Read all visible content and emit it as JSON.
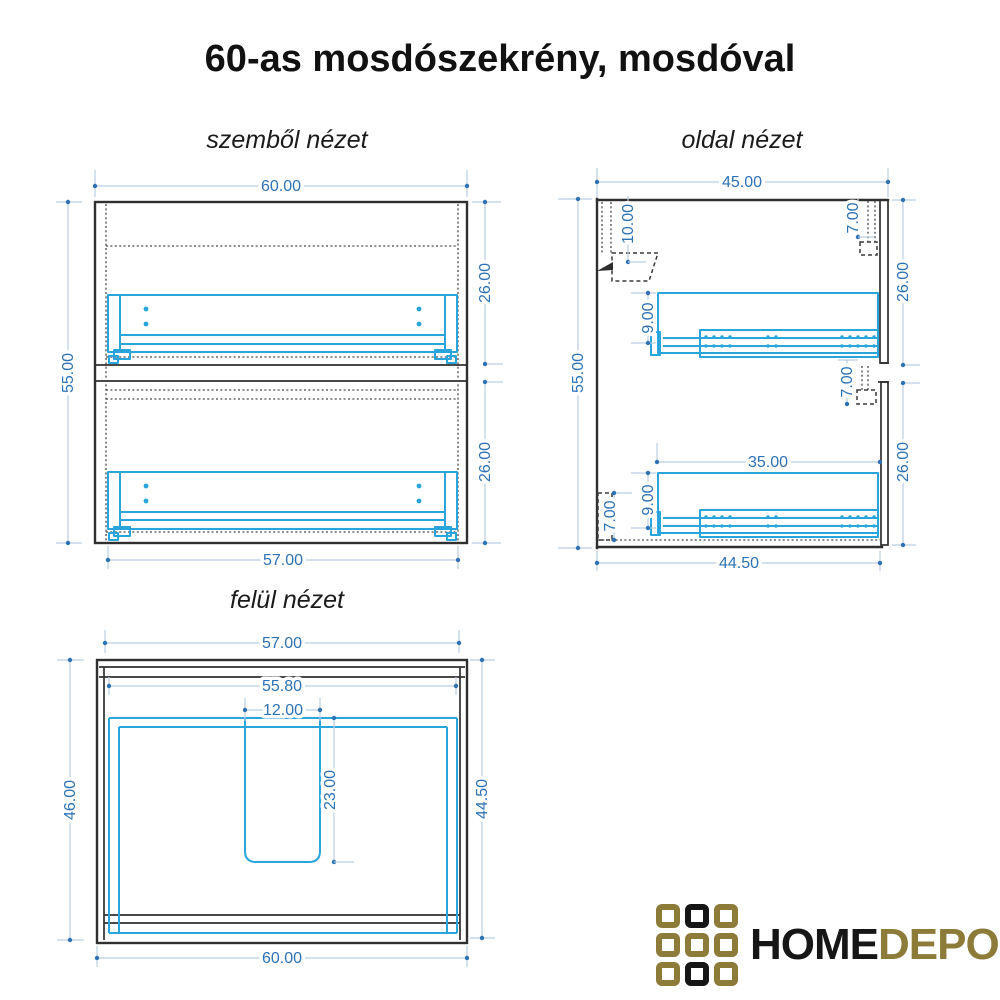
{
  "title": "60-as mosdószekrény, mosdóval",
  "views": {
    "front": {
      "label": "szemből nézet",
      "dims": {
        "width_top": "60.00",
        "height_left": "55.00",
        "upper_drawer_right": "26.00",
        "lower_drawer_right": "26.00",
        "width_bottom": "57.00"
      }
    },
    "side": {
      "label": "oldal nézet",
      "dims": {
        "depth_top": "45.00",
        "height_left": "55.00",
        "top_inset_right": "7.00",
        "upper_drawer_right": "26.00",
        "mid_inset_right": "7.00",
        "lower_drawer_right": "26.00",
        "bracket_depth": "10.00",
        "upper_rail_height": "9.00",
        "rail_length": "35.00",
        "lower_rail_height": "9.00",
        "bottom_inset_left": "7.00",
        "depth_bottom": "44.50"
      }
    },
    "top": {
      "label": "felül nézet",
      "dims": {
        "width_top": "57.00",
        "inner_width": "55.80",
        "cutout_width": "12.00",
        "depth_left": "46.00",
        "cutout_depth": "23.00",
        "depth_right": "44.50",
        "width_bottom": "60.00"
      }
    }
  },
  "logo": {
    "home": "HOME",
    "depo": "DEPO",
    "grid": [
      "gold",
      "black",
      "gold",
      "gold",
      "gold",
      "gold",
      "gold",
      "black",
      "gold"
    ]
  },
  "colors": {
    "dimension_text": "#2d72b4",
    "dimension_line": "#b9cfe3",
    "drawing_accent": "#29a5db",
    "outline": "#2f2f2f",
    "logo_gold": "#8d7b3a",
    "logo_black": "#161616"
  }
}
